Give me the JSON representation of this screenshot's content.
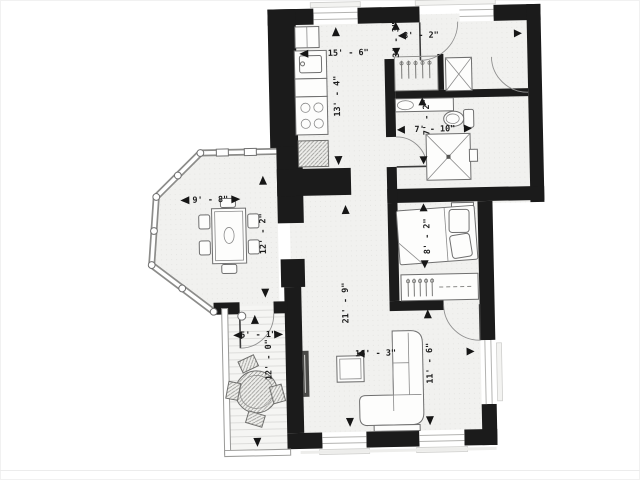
{
  "document": {
    "type": "apartment-floor-plan",
    "background_color": "#ffffff"
  },
  "colors": {
    "wall": "#1b1b1b",
    "floor": "#f1f1ef",
    "deck_floor": "#f4f4f2",
    "window": "#b3b3b1",
    "dimension_text": "#1c1c1c"
  },
  "dimensions": {
    "entry_width": "8' - 2\"",
    "entry_depth": "3' - 3\"",
    "kitchen_width": "15' - 6\"",
    "kitchen_length": "13' - 4\"",
    "bath_length": "7' - 2\"",
    "bath_width": "7' - 10\"",
    "bedroom_width": "8' - 2\"",
    "dining_width": "9' - 8\"",
    "dining_length": "12' - 2\"",
    "hall_length": "21' - 9\"",
    "living_width": "16' - 3\"",
    "living_length": "11' - 6\"",
    "balcony_width": "5' - 1\"",
    "balcony_length": "12' - 0\""
  }
}
